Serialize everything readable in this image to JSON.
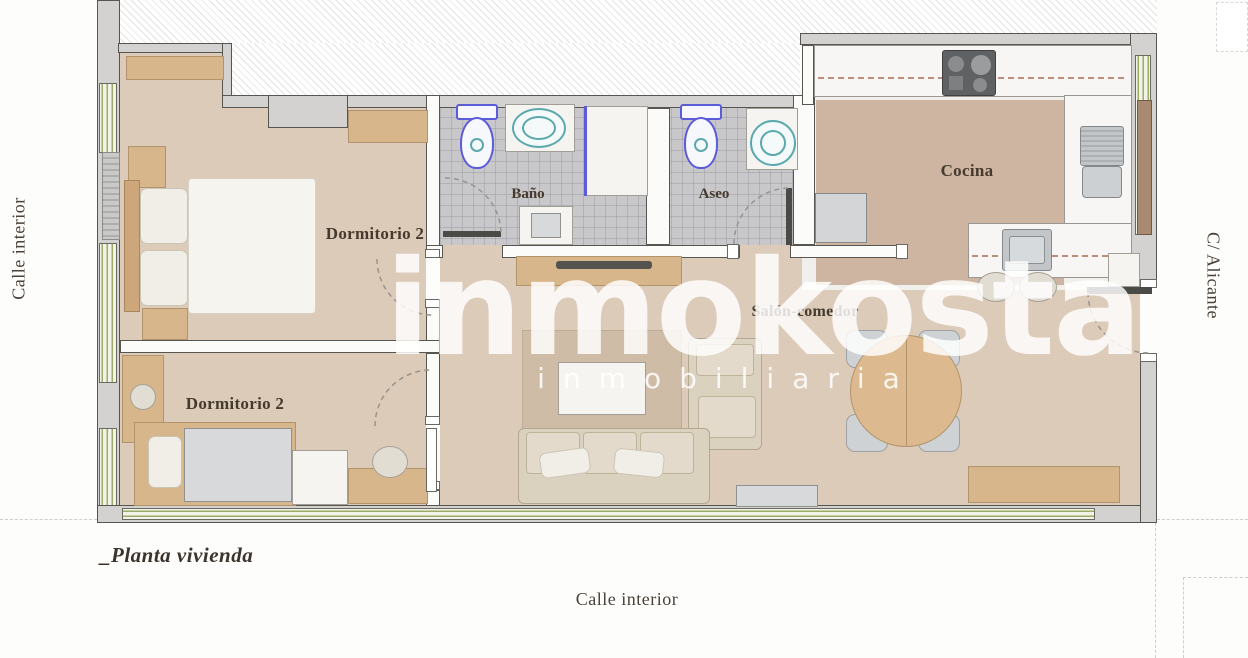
{
  "plan": {
    "title": "_Planta vivienda",
    "streets": {
      "left": "Calle interior",
      "bottom": "Calle interior",
      "right": "C/ Alicante"
    },
    "rooms": {
      "dormitorio_top": "Dormitorio 2",
      "dormitorio_bottom": "Dormitorio 2",
      "bano": "Baño",
      "aseo": "Aseo",
      "cocina": "Cocina",
      "salon": "Salón-comedor"
    },
    "watermark": {
      "brand": "inmokosta",
      "tagline": "inmobiliaria"
    },
    "colors": {
      "wall_fill": "#d3d2d0",
      "wall_line": "#57554f",
      "floor_beige": "#dccbb9",
      "kitchen_floor": "#cdb5a1",
      "bath_tile": "#c8c8cb",
      "window_green": "#9cab66",
      "wood": "#d8b68c",
      "fixture_blue": "#5c5cd8",
      "fixture_teal": "#5ba8ad",
      "label_brown": "#453a2d",
      "cabinet_dash": "#bd8f7a",
      "watermark_white": "#ffffff"
    }
  }
}
